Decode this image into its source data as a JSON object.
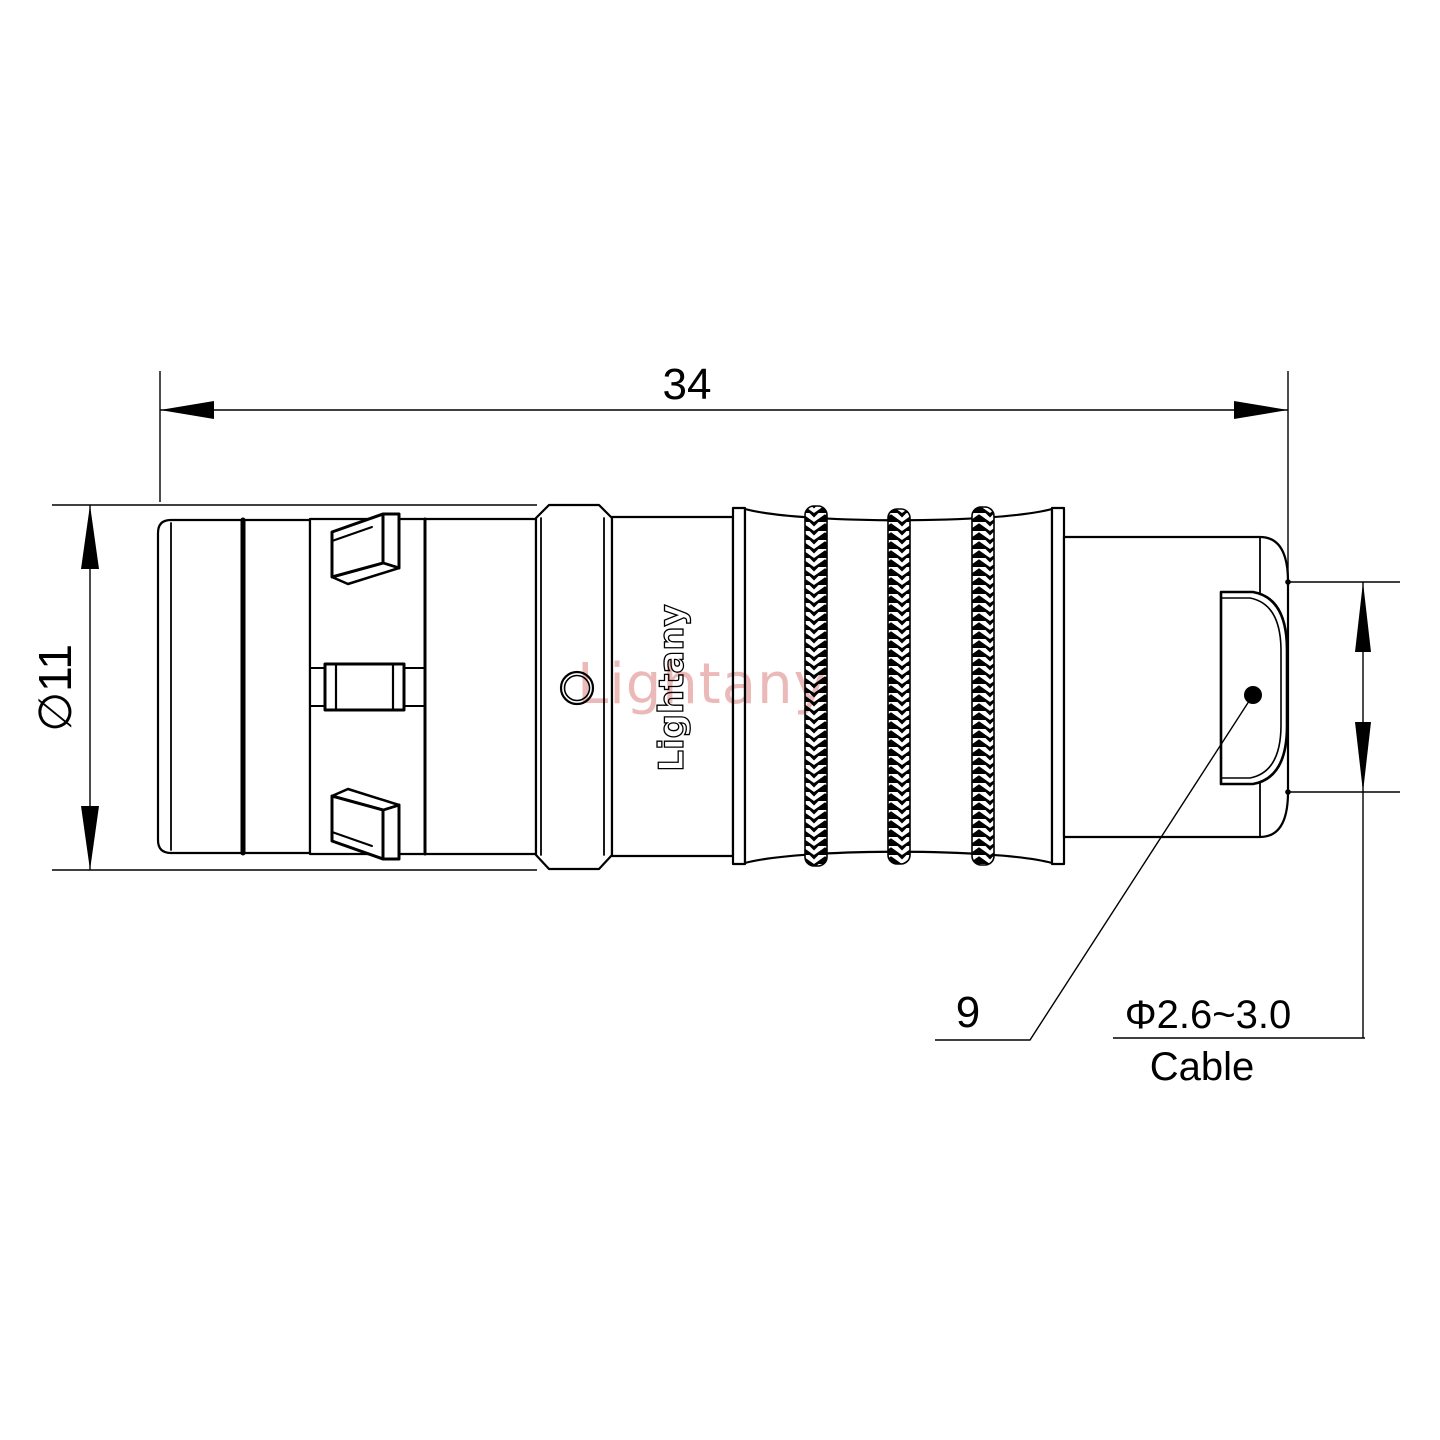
{
  "canvas": {
    "background": "#ffffff",
    "line_color": "#000000",
    "watermark_color": "#ecb9b9"
  },
  "watermark": {
    "text": "Lightany"
  },
  "connector": {
    "brand_engraving": "Lightany"
  },
  "dimensions": {
    "overall_length": {
      "label": "34"
    },
    "outer_diameter": {
      "label": "∅11"
    },
    "backshell_size": {
      "label": "9"
    },
    "cable_spec": {
      "diameter_label": "Φ2.6~3.0",
      "type_label": "Cable"
    }
  }
}
